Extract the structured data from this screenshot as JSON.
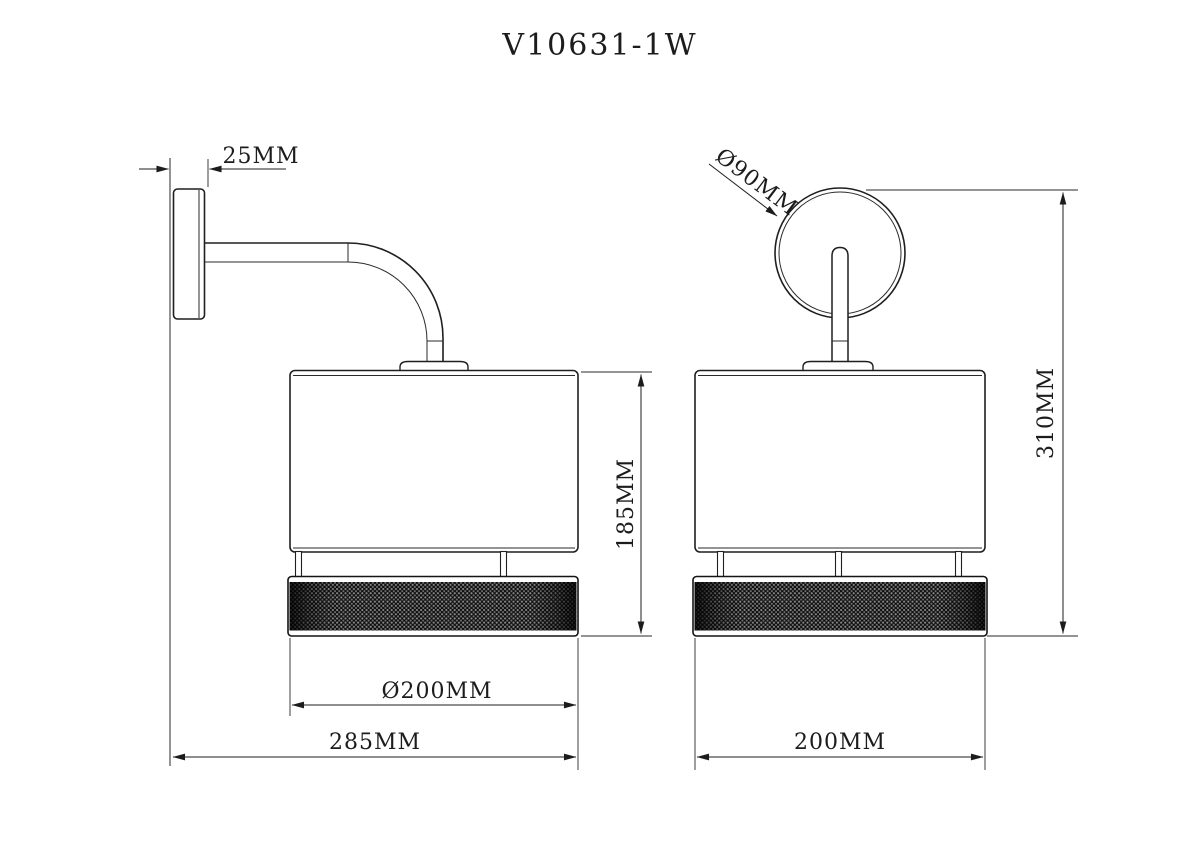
{
  "title": "V10631-1W",
  "side_view": {
    "dim_wall_plate_depth": "25MM",
    "dim_shade_height": "185MM",
    "dim_shade_diameter": "Ø200MM",
    "dim_total_projection": "285MM"
  },
  "front_view": {
    "dim_backplate_diameter": "Ø90MM",
    "dim_total_height": "310MM",
    "dim_shade_width": "200MM"
  },
  "colors": {
    "background": "#ffffff",
    "line": "#1f1f1f",
    "dimension": "#1c1c1c",
    "mesh_base": "#0e0e0e",
    "mesh_dot": "#8f8f8f"
  }
}
